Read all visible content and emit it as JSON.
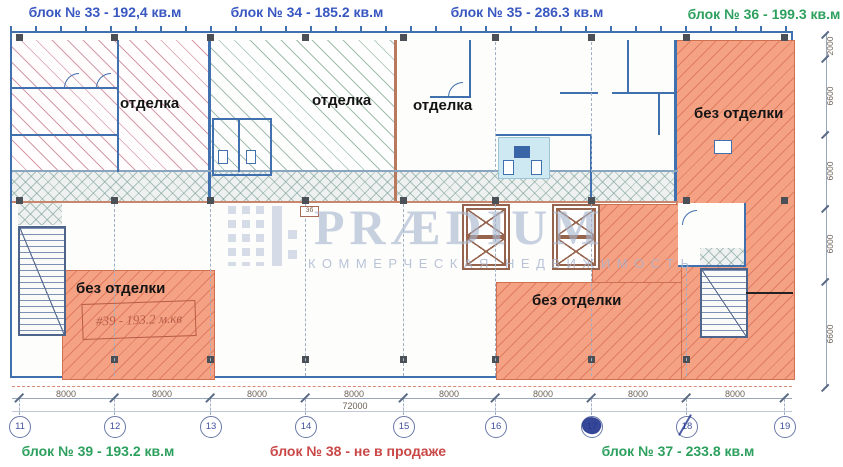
{
  "header_labels": [
    {
      "text": "блок № 33 - 192,4 кв.м",
      "color": "#3857c0"
    },
    {
      "text": "блок № 34 - 185.2 кв.м",
      "color": "#3857c0"
    },
    {
      "text": "блок № 35 - 286.3 кв.м",
      "color": "#3857c0"
    },
    {
      "text": "блок № 36 - 199.3 кв.м",
      "color": "#2da05e"
    }
  ],
  "footer_labels": [
    {
      "text": "блок № 39 - 193.2 кв.м",
      "color": "#2da05e"
    },
    {
      "text": "блок № 38 - не в продаже",
      "color": "#c94747"
    },
    {
      "text": "блок № 37 - 233.8 кв.м",
      "color": "#2da05e"
    }
  ],
  "rooms": [
    {
      "id": "block-33",
      "status": "отделка"
    },
    {
      "id": "block-34",
      "status": "отделка"
    },
    {
      "id": "block-35",
      "status": "отделка"
    },
    {
      "id": "block-36",
      "status": "без отделки"
    },
    {
      "id": "block-39",
      "status": "без отделки",
      "note": "#39 - 193.2 м.кв"
    },
    {
      "id": "block-38",
      "status": "без отделки"
    }
  ],
  "plan": {
    "column_tag": "3б"
  },
  "watermark": {
    "title": "PRÆDIUM",
    "subtitle": "КОММЕРЧЕСКАЯ НЕДВИЖИМОСТЬ"
  },
  "dimensions": {
    "bay_labels": [
      "8000",
      "8000",
      "8000",
      "8000",
      "8000",
      "8000",
      "8000",
      "8000"
    ],
    "total_label": "72000",
    "grid_bubbles": [
      "11",
      "12",
      "13",
      "14",
      "15",
      "16",
      "17",
      "18",
      "19"
    ],
    "ink_marked_bubbles": [
      "17",
      "18"
    ],
    "vertical_labels": [
      "2000",
      "6600",
      "6000",
      "6000",
      "6600"
    ]
  },
  "colors": {
    "label_blue": "#3857c0",
    "label_green": "#2da05e",
    "label_red": "#c94747",
    "wall_blue": "#4070ad",
    "unfinished_fill": "#f5a184",
    "finished_hatch_pink": "#ce8a98",
    "finished_hatch_green": "#7aa28a",
    "watermark_gray": "#a7b4cd"
  }
}
